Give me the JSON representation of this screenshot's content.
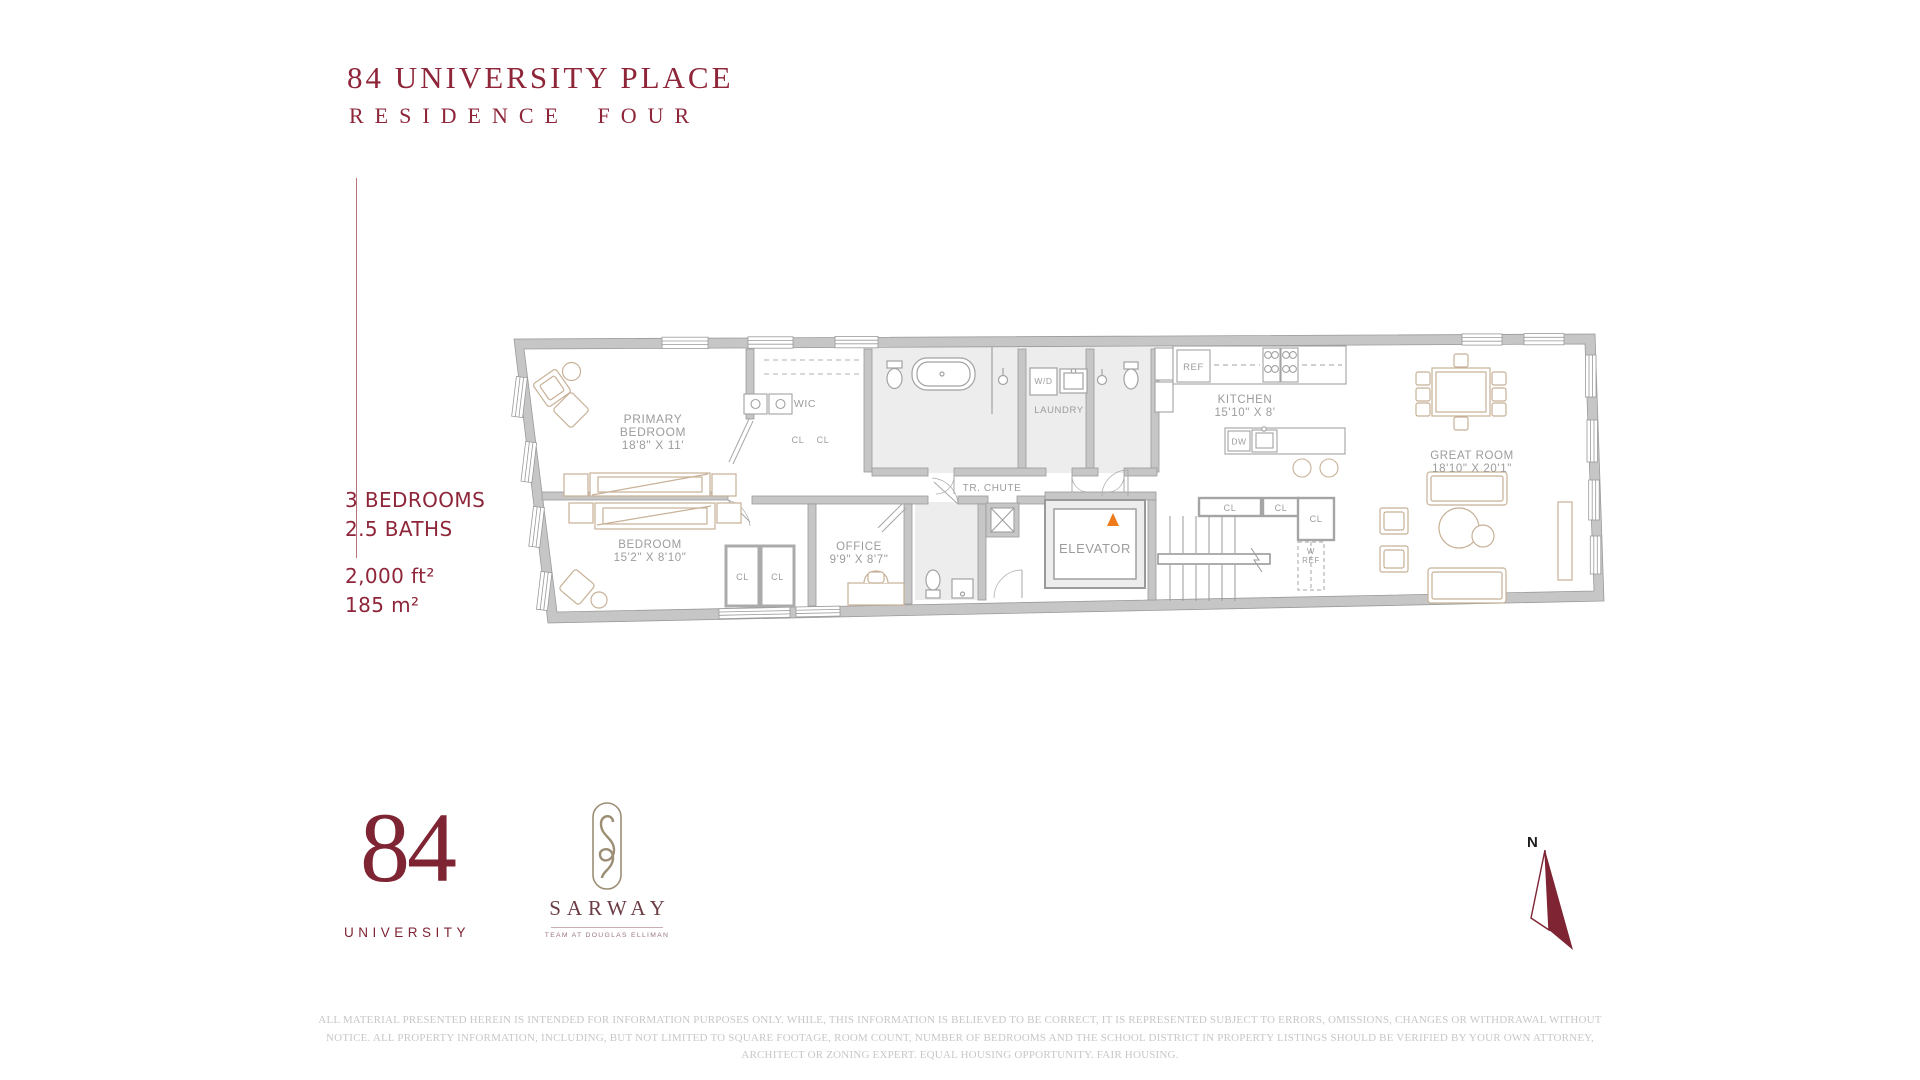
{
  "header": {
    "title": "84 UNIVERSITY PLACE",
    "subtitle": "RESIDENCE FOUR"
  },
  "stats": {
    "bedrooms": "3 BEDROOMS",
    "baths": "2.5 BATHS",
    "area_ft": "2,000 ft²",
    "area_m": "185 m²"
  },
  "floorplan": {
    "primary_bedroom_l1": "PRIMARY",
    "primary_bedroom_l2": "BEDROOM",
    "primary_bedroom_dims": "18'8\" X 11'",
    "wic": "WIC",
    "bedroom": "BEDROOM",
    "bedroom_dims": "15'2\" X 8'10\"",
    "office": "OFFICE",
    "office_dims": "9'9\" X 8'7\"",
    "laundry": "LAUNDRY",
    "wd": "W/D",
    "tr_chute": "TR. CHUTE",
    "elevator": "ELEVATOR",
    "kitchen": "KITCHEN",
    "kitchen_dims": "15'10\" X 8'",
    "great_room": "GREAT ROOM",
    "great_room_dims": "18'10\" X 20'1\"",
    "ref": "REF",
    "dw": "DW",
    "cl": "CL",
    "w_ref_l1": "W",
    "w_ref_l2": "REF"
  },
  "branding": {
    "logo_number": "84",
    "logo_text": "UNIVERSITY",
    "team": "SARWAY",
    "team_tagline": "TEAM AT DOUGLAS ELLIMAN"
  },
  "compass": {
    "north": "N"
  },
  "disclaimer": {
    "line1": "ALL MATERIAL PRESENTED HEREIN IS INTENDED FOR INFORMATION PURPOSES ONLY. WHILE, THIS INFORMATION IS BELIEVED TO BE CORRECT, IT IS REPRESENTED SUBJECT TO ERRORS, OMISSIONS, CHANGES OR WITHDRAWAL WITHOUT",
    "line2": "NOTICE. ALL PROPERTY INFORMATION, INCLUDING, BUT NOT LIMITED TO SQUARE FOOTAGE, ROOM COUNT, NUMBER OF BEDROOMS AND THE SCHOOL DISTRICT IN PROPERTY LISTINGS SHOULD BE VERIFIED BY YOUR OWN ATTORNEY,",
    "line3": "ARCHITECT OR ZONING EXPERT. EQUAL HOUSING OPPORTUNITY. FAIR HOUSING."
  },
  "colors": {
    "brand_red": "#8E2539",
    "logo_red": "#7E2433",
    "accent_orange": "#EE7A1A",
    "wall_gray": "#C6C6C6",
    "label_gray": "#9C9C9C",
    "furniture_tan": "#C7B197",
    "disclaimer_gray": "#C7C7C7"
  }
}
